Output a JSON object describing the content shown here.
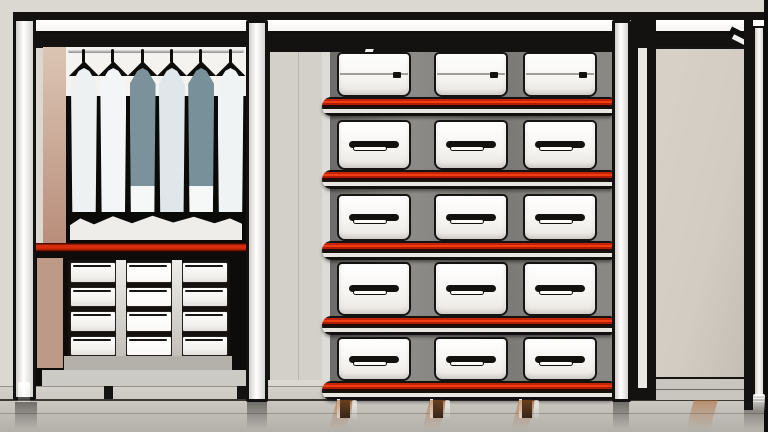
{
  "scene": {
    "description": "Stylized closet system: six shirts hanging on a rod above a small chest of drawers on the left, a central shelving unit holding five rows of white storage boxes on black shelves with red edge trim, and an empty open compartment with a beige back panel on the right.",
    "palette": {
      "wall": "#dbd8d2",
      "frame_black": "#131211",
      "post_white": "#f7f6f3",
      "accent_red": "#cf2403",
      "accent_red_bright": "#f23d13",
      "shelf_light": "#e9e6e1",
      "box_white": "#f8f6f3",
      "bay_gray": "#7e7c78",
      "side_panel": "#d3d0ca",
      "tan_upper_top": "#dcc5b4",
      "tan_upper_bottom": "#b98e7b",
      "tan_lower": "#bd9a88",
      "hang_black": "#0a0a09",
      "lit_band": "#efede9",
      "shirt_cuff": "#f6f7f7",
      "beige_panel": "#d2ccc2",
      "floor_light": "#d5d2cc",
      "floor_dark": "#b3b0aa"
    },
    "left_unit": {
      "shirt_count": 6,
      "shirts": [
        {
          "fill": "#edf1f2",
          "cuff": false
        },
        {
          "fill": "#f3f5f6",
          "cuff": false
        },
        {
          "fill": "#7b929b",
          "cuff": true
        },
        {
          "fill": "#dfe7ea",
          "cuff": false
        },
        {
          "fill": "#78909a",
          "cuff": true
        },
        {
          "fill": "#f0f3f4",
          "cuff": false
        }
      ],
      "drawer_rows": 4,
      "drawer_cols": 3
    },
    "shelf_unit": {
      "box_rows": 5,
      "box_cols": 3,
      "shelf_count": 5,
      "leg_count": 3
    }
  }
}
